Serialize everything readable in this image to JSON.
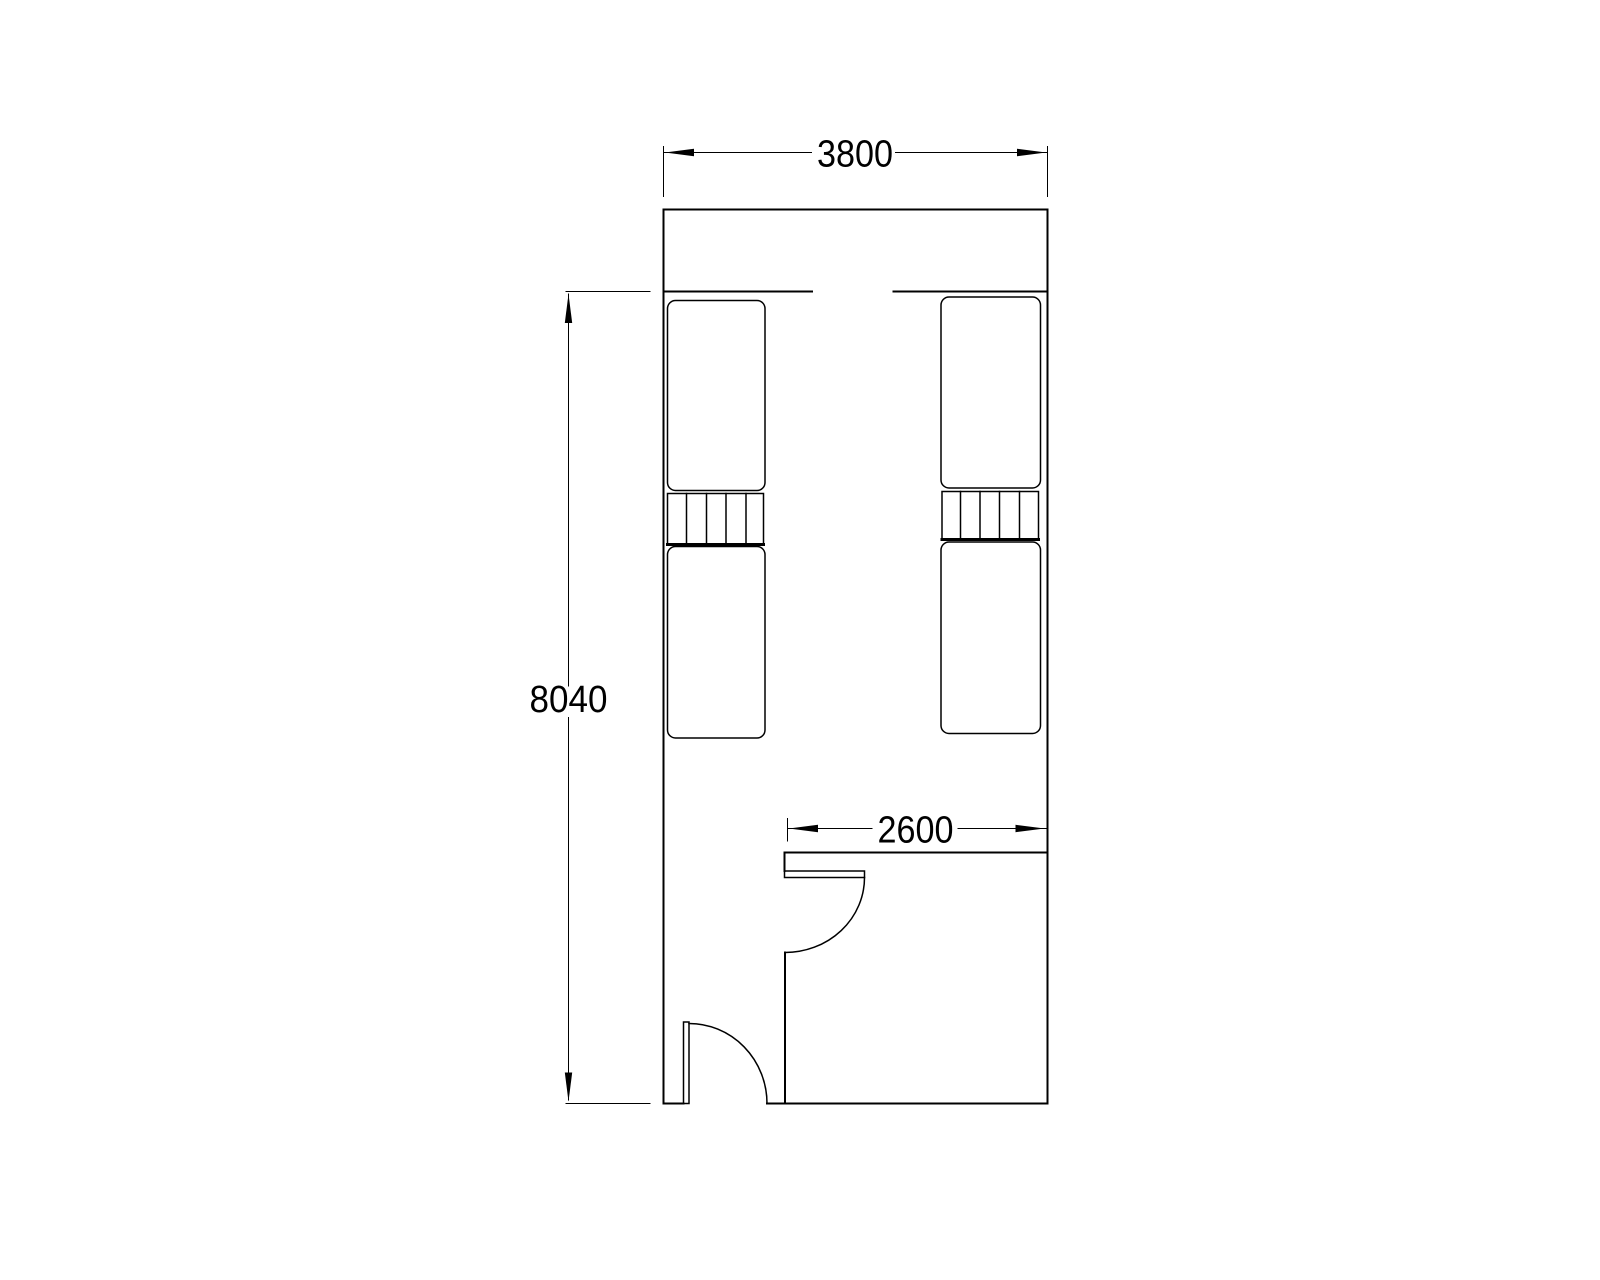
{
  "drawing": {
    "background_color": "#ffffff",
    "line_color": "#000000",
    "dimensions": {
      "overall_width": "3800",
      "overall_height": "8040",
      "room_width": "2600"
    }
  }
}
